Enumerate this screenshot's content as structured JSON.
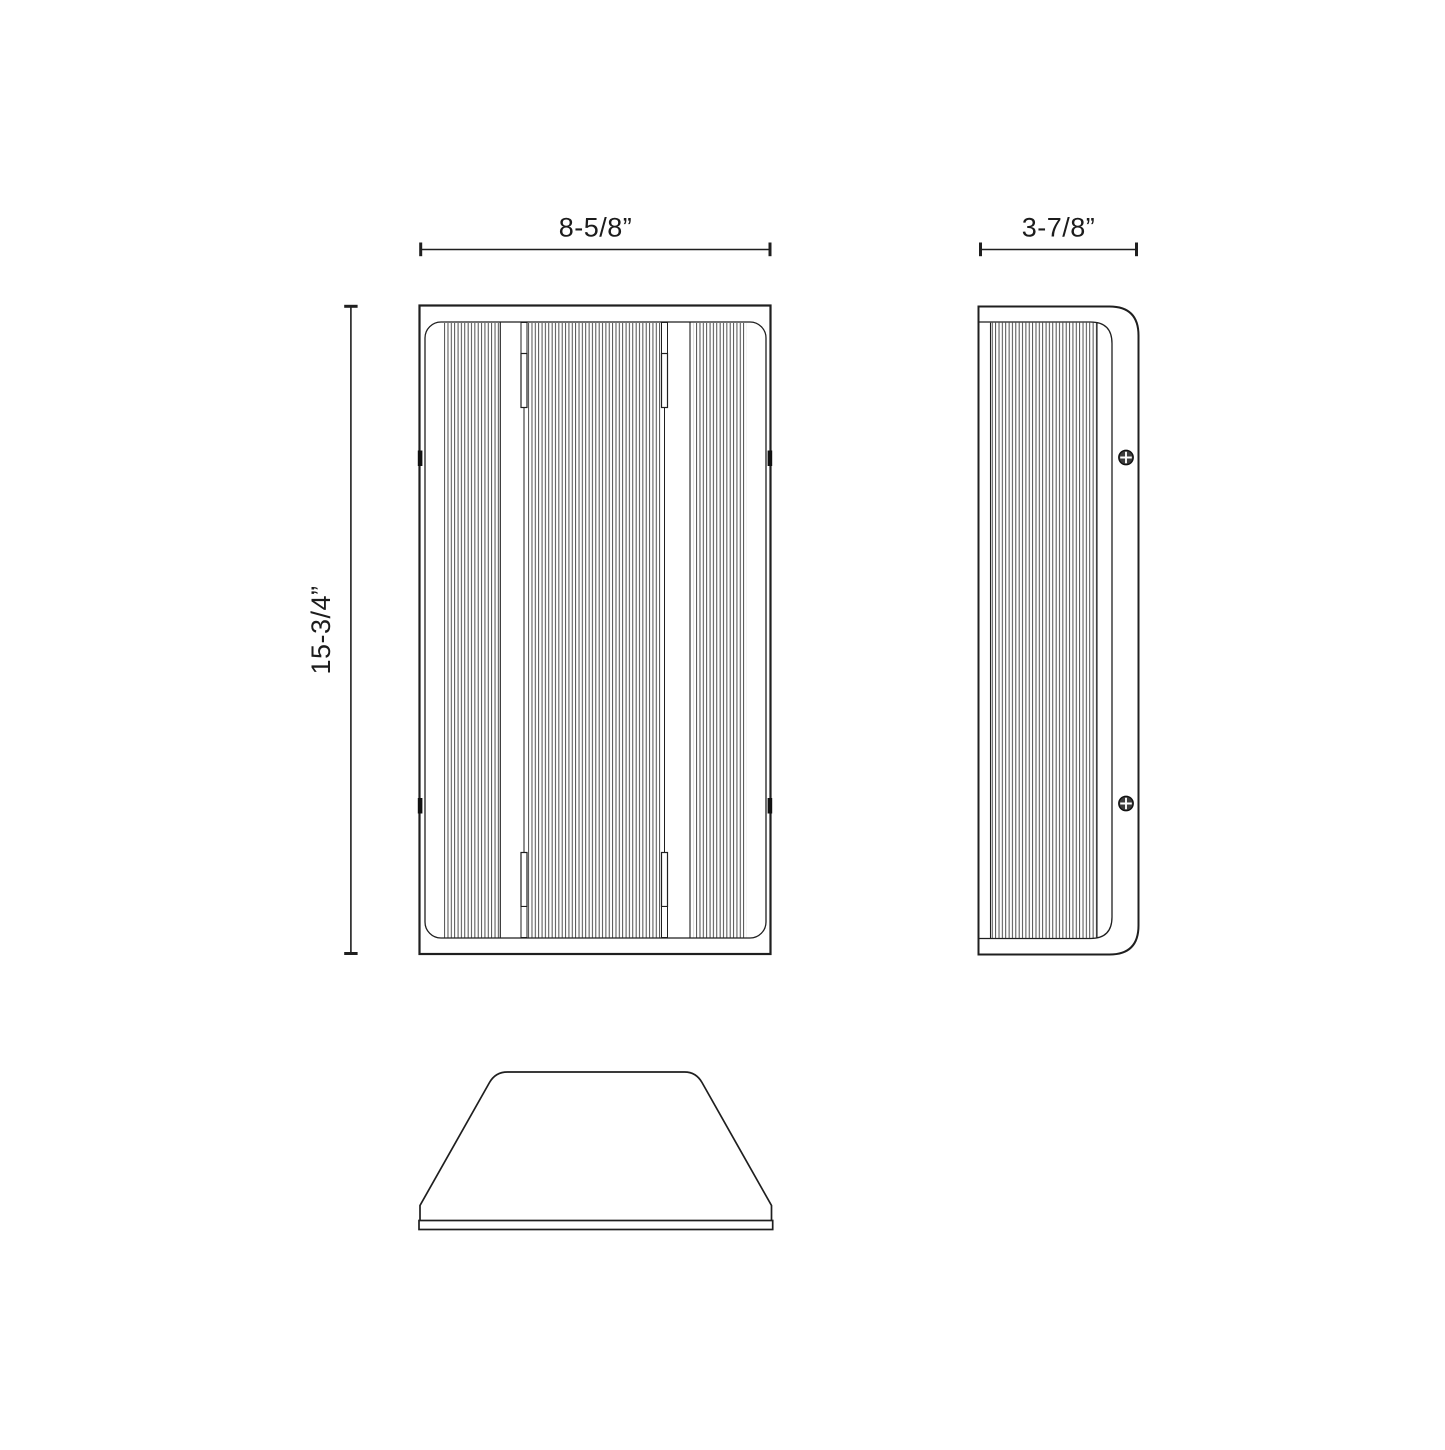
{
  "document": {
    "kind": "technical-dimension-drawing",
    "background_color": "#ffffff",
    "line_color": "#1f1f1f",
    "rib_line_color": "#2e2e2e"
  },
  "views": {
    "front": {
      "name": "front-view"
    },
    "side": {
      "name": "side-profile-view"
    },
    "bottom": {
      "name": "bottom-profile-view"
    }
  },
  "icons": {
    "screw": "phillips-screw-icon"
  },
  "dimensions": {
    "width": {
      "label": "8-5/8”"
    },
    "depth": {
      "label": "3-7/8”"
    },
    "height": {
      "label": "15-3/4”"
    }
  }
}
